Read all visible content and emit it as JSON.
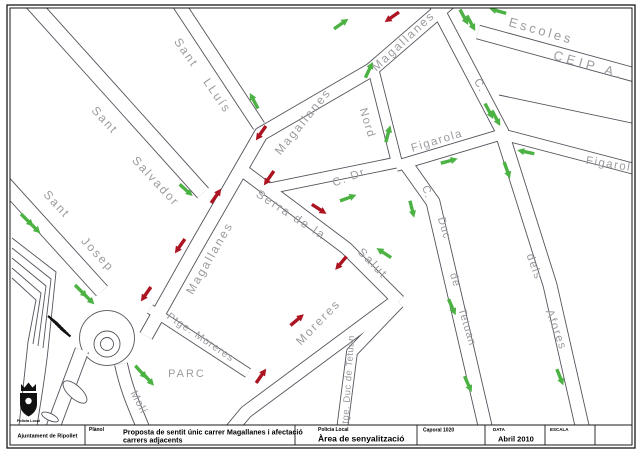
{
  "title_block": {
    "org": "Ajuntament de Ripollet",
    "plan_label": "Plànol",
    "plan_title_line1": "Proposta de sentit únic carrer Magallanes i afectació",
    "plan_title_line2": "carrers adjacents",
    "dept_label": "Policia Local",
    "dept_title": "Àrea de senyalització",
    "author": "Caporal 1020",
    "date_label": "DATA",
    "date_value": "Abril 2010",
    "scale_label": "ESCALA",
    "logo_caption": "Policia Local"
  },
  "map": {
    "colors": {
      "street_casing": "#56525c",
      "label": "#9c9ca0",
      "arrow_green": "#4cb243",
      "arrow_red": "#ab1420"
    },
    "street_labels": [
      {
        "text": "Sant",
        "x": 183,
        "y": 55,
        "rot": 55,
        "fs": 12,
        "ls": 2
      },
      {
        "text": "LLuís",
        "x": 214,
        "y": 98,
        "rot": 55,
        "fs": 12,
        "ls": 2
      },
      {
        "text": "Sant",
        "x": 102,
        "y": 123,
        "rot": 47,
        "fs": 12,
        "ls": 2
      },
      {
        "text": "Salvador",
        "x": 153,
        "y": 184,
        "rot": 47,
        "fs": 12,
        "ls": 2
      },
      {
        "text": "Sant",
        "x": 54,
        "y": 207,
        "rot": 47,
        "fs": 12,
        "ls": 2
      },
      {
        "text": "Josep",
        "x": 95,
        "y": 257,
        "rot": 47,
        "fs": 12,
        "ls": 2
      },
      {
        "text": "Magallanes",
        "x": 406,
        "y": 44,
        "rot": -43,
        "fs": 12,
        "ls": 2
      },
      {
        "text": "Magallanes",
        "x": 306,
        "y": 124,
        "rot": -51,
        "fs": 12,
        "ls": 2
      },
      {
        "text": "Magallanes",
        "x": 213,
        "y": 260,
        "rot": -60,
        "fs": 12,
        "ls": 2
      },
      {
        "text": "Serra de la",
        "x": 289,
        "y": 218,
        "rot": 33,
        "fs": 12,
        "ls": 2
      },
      {
        "text": "Salut",
        "x": 370,
        "y": 266,
        "rot": 46,
        "fs": 12,
        "ls": 2
      },
      {
        "text": "Moreres",
        "x": 321,
        "y": 325,
        "rot": -46,
        "fs": 12,
        "ls": 2
      },
      {
        "text": "Ptge. Moreres",
        "x": 199,
        "y": 340,
        "rot": 34,
        "fs": 10.5,
        "ls": 1
      },
      {
        "text": "PARC",
        "x": 187,
        "y": 377,
        "rot": 0,
        "fs": 11,
        "ls": 2
      },
      {
        "text": "Molí",
        "x": 136,
        "y": 404,
        "rot": 62,
        "fs": 11,
        "ls": 1
      },
      {
        "text": "C.  Dr.",
        "x": 352,
        "y": 180,
        "rot": -20,
        "fs": 11.5,
        "ls": 1.5
      },
      {
        "text": "Nord",
        "x": 364,
        "y": 124,
        "rot": 73,
        "fs": 11.5,
        "ls": 1.5
      },
      {
        "text": "Figarola",
        "x": 438,
        "y": 144,
        "rot": -17,
        "fs": 11.5,
        "ls": 1.5
      },
      {
        "text": "Figarola",
        "x": 612,
        "y": 168,
        "rot": 9,
        "fs": 11.5,
        "ls": 1.5
      },
      {
        "text": "C.",
        "x": 477,
        "y": 87,
        "rot": 60,
        "fs": 11.5,
        "ls": 1
      },
      {
        "text": "C.",
        "x": 424,
        "y": 193,
        "rot": 73,
        "fs": 11,
        "ls": 1
      },
      {
        "text": "Duc",
        "x": 441,
        "y": 229,
        "rot": 73,
        "fs": 11,
        "ls": 1
      },
      {
        "text": "de",
        "x": 452,
        "y": 281,
        "rot": 73,
        "fs": 11,
        "ls": 1
      },
      {
        "text": "Tetuan",
        "x": 464,
        "y": 328,
        "rot": 73,
        "fs": 11,
        "ls": 1
      },
      {
        "text": "dels",
        "x": 531,
        "y": 268,
        "rot": 70,
        "fs": 11.5,
        "ls": 1.5
      },
      {
        "text": "Afores",
        "x": 553,
        "y": 331,
        "rot": 70,
        "fs": 11.5,
        "ls": 1.5
      },
      {
        "text": "Ptge. Duc de Tetuan",
        "x": 351,
        "y": 383,
        "rot": -86,
        "fs": 9.5,
        "ls": 0.5
      },
      {
        "text": "Escoles",
        "x": 540,
        "y": 35,
        "rot": 16,
        "fs": 13,
        "ls": 3
      },
      {
        "text": "CEIP A. C",
        "x": 598,
        "y": 72,
        "rot": 16,
        "fs": 13,
        "ls": 4
      }
    ],
    "arrows": [
      {
        "x": 392,
        "y": 17,
        "rot": 145,
        "c": "red"
      },
      {
        "x": 261,
        "y": 133,
        "rot": 125,
        "c": "red"
      },
      {
        "x": 269,
        "y": 178,
        "rot": 125,
        "c": "red"
      },
      {
        "x": 216,
        "y": 196,
        "rot": -55,
        "c": "red"
      },
      {
        "x": 180,
        "y": 246,
        "rot": 125,
        "c": "red"
      },
      {
        "x": 146,
        "y": 294,
        "rot": 125,
        "c": "red"
      },
      {
        "x": 297,
        "y": 320,
        "rot": -40,
        "c": "red"
      },
      {
        "x": 261,
        "y": 376,
        "rot": -55,
        "c": "red"
      },
      {
        "x": 319,
        "y": 209,
        "rot": 33,
        "c": "red"
      },
      {
        "x": 341,
        "y": 263,
        "rot": 130,
        "c": "red"
      },
      {
        "x": 254,
        "y": 101,
        "rot": -118,
        "c": "green"
      },
      {
        "x": 186,
        "y": 190,
        "rot": 42,
        "c": "green"
      },
      {
        "x": 27,
        "y": 220,
        "rot": 45,
        "c": "green"
      },
      {
        "x": 34,
        "y": 227,
        "rot": 45,
        "c": "green"
      },
      {
        "x": 81,
        "y": 291,
        "rot": 45,
        "c": "green"
      },
      {
        "x": 88,
        "y": 298,
        "rot": 45,
        "c": "green"
      },
      {
        "x": 141,
        "y": 372,
        "rot": 48,
        "c": "green"
      },
      {
        "x": 148,
        "y": 379,
        "rot": 48,
        "c": "green"
      },
      {
        "x": 341,
        "y": 24,
        "rot": -35,
        "c": "green"
      },
      {
        "x": 464,
        "y": 17,
        "rot": 62,
        "c": "green"
      },
      {
        "x": 471,
        "y": 23,
        "rot": 62,
        "c": "green"
      },
      {
        "x": 498,
        "y": 11,
        "rot": 196,
        "c": "green"
      },
      {
        "x": 369,
        "y": 70,
        "rot": -65,
        "c": "green"
      },
      {
        "x": 388,
        "y": 134,
        "rot": -75,
        "c": "green"
      },
      {
        "x": 489,
        "y": 111,
        "rot": 62,
        "c": "green"
      },
      {
        "x": 496,
        "y": 118,
        "rot": 62,
        "c": "green"
      },
      {
        "x": 449,
        "y": 161,
        "rot": -15,
        "c": "green"
      },
      {
        "x": 526,
        "y": 152,
        "rot": 192,
        "c": "green"
      },
      {
        "x": 507,
        "y": 170,
        "rot": 70,
        "c": "green"
      },
      {
        "x": 412,
        "y": 209,
        "rot": 76,
        "c": "green"
      },
      {
        "x": 384,
        "y": 253,
        "rot": 213,
        "c": "green"
      },
      {
        "x": 452,
        "y": 307,
        "rot": 66,
        "c": "green"
      },
      {
        "x": 468,
        "y": 384,
        "rot": 66,
        "c": "green"
      },
      {
        "x": 560,
        "y": 377,
        "rot": 68,
        "c": "green"
      },
      {
        "x": 348,
        "y": 198,
        "rot": -20,
        "c": "green"
      }
    ]
  }
}
